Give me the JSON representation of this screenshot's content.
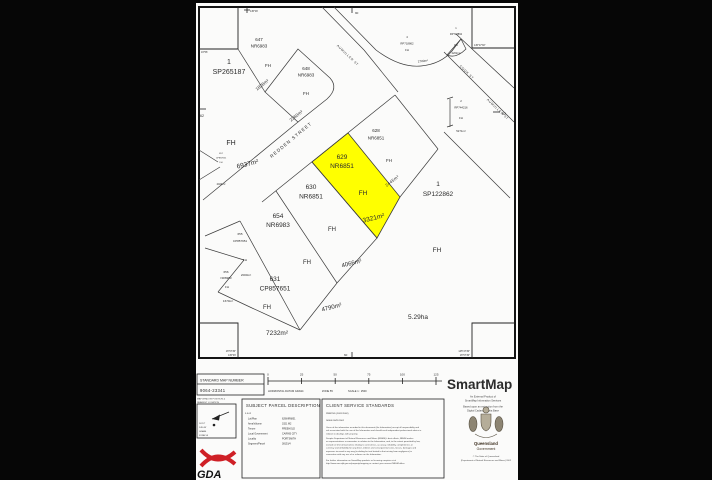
{
  "map": {
    "fh_label": "FH",
    "parcels": {
      "p647": {
        "lot": "647",
        "plan": "NR6983"
      },
      "p648": {
        "lot": "648",
        "plan": "NR6983"
      },
      "sp265187": {
        "lot": "1",
        "plan": "SP265187"
      },
      "rp718862a": {
        "lot": "4",
        "plan": "RP718862"
      },
      "rp718862b": {
        "lot": "1",
        "plan": "RP718862"
      },
      "rp744216": {
        "lot": "2",
        "plan": "RP744216"
      },
      "p628": {
        "lot": "628",
        "plan": "NR6851"
      },
      "p629": {
        "lot": "629",
        "plan": "NR6851"
      },
      "p630": {
        "lot": "630",
        "plan": "NR6851"
      },
      "sp122862": {
        "lot": "1",
        "plan": "SP122862"
      },
      "p654": {
        "lot": "654",
        "plan": "NR6983"
      },
      "p655": {
        "lot": "655",
        "plan": "CP857651"
      },
      "p656": {
        "lot": "656",
        "plan": "NR6983"
      },
      "p631": {
        "lot": "631",
        "plan": "CP857651"
      },
      "p657": {
        "lot": "657",
        "plan": "CP857651"
      }
    },
    "areas": {
      "a647": "1828m²",
      "a648": "2360m²",
      "a6937": "6937m²",
      "a2700": "2700m²",
      "a2202": "2202m²",
      "a5271": "5271m²",
      "a2445": "2445m²",
      "a3321": "3321m²",
      "a4066": "4066m²",
      "a4790": "4790m²",
      "a7232": "7232m²",
      "a529": "5.29ha",
      "a2000": "2000m²",
      "a1670": "1670m²",
      "a2024": "2024m²"
    },
    "streets": {
      "redden": "REDDEN STREET",
      "aumuller": "AUMULLER ST",
      "cook": "COOK ST",
      "aumuller2": "AUMULLER ST"
    },
    "edges": {
      "left": "62",
      "right": "62",
      "top": "90",
      "bottom": "60"
    },
    "corners": {
      "tl": "145°46'",
      "tr": "145°47'30\"",
      "lm": "16°56'",
      "bl1": "16°57'30\"",
      "bl2": "145°46'",
      "br1": "145°47'30\"",
      "br2": "16°57'30\""
    },
    "highlight_color": "#ffff00"
  },
  "footer": {
    "map_number_box": {
      "title": "STANDARD MAP NUMBER",
      "number": "9064-23341"
    },
    "window_note": [
      "MAP WINDOW POSITION &",
      "NEAREST LOCATION"
    ],
    "scalebar": {
      "ticks": [
        "0",
        "25",
        "50",
        "75",
        "100",
        "125"
      ],
      "datum": "HORIZONTAL DATUM GDA94",
      "zone": "ZONE 55",
      "scale": "SCALE 1 : 2500"
    },
    "north_box": [
      "16°57'",
      "145°46'",
      "GDA94",
      "ZONE 55"
    ],
    "brand": {
      "name": "SmartMap",
      "color": "#2a2ac8",
      "tagline1": "An External Product of",
      "tagline2": "SmartMap Information Services",
      "tagline3": "Based upon an extraction from the",
      "tagline4": "Digital Cadastral Data Base"
    },
    "gda": {
      "label": "GDA"
    },
    "subject": {
      "title": "SUBJECT PARCEL DESCRIPTION",
      "code": "5.5.02",
      "fields": [
        {
          "label": "Lot/Plan",
          "value": "629/NR6851"
        },
        {
          "label": "Area/Volume",
          "value": "3321 M2"
        },
        {
          "label": "Tenure",
          "value": "FREEHOLD"
        },
        {
          "label": "Local Government",
          "value": "CAIRNS CITY"
        },
        {
          "label": "Locality",
          "value": "PORTSMITH"
        },
        {
          "label": "Segment/Parcel",
          "value": "38151/4"
        }
      ]
    },
    "client": {
      "title": "CLIENT SERVICE STANDARDS",
      "printed": "PRINTED (20/11/2002)",
      "issue": "ISSUE    30/11/2002",
      "para": [
        "Users of the information recorded in this document (the Information) accept all responsibility and",
        "risk associated with the use of the Information and should seek independent professional advice in",
        "relation to dealings with property.",
        "Despite Department of Natural Resources and Mines (NR&M)'s best efforts, NR&M makes",
        "no representations or warranties in relation to the Information, and, to the extent permitted by law,",
        "exclude or limit all warranties relating to correctness, accuracy, reliability, completeness or",
        "currency and all liability for any direct, indirect and consequential costs, losses, damages and",
        "expenses incurred in any way (including but not limited to that arising from negligence) in",
        "connection with any use of or reliance on the Information.",
        "For further information on SmartMap products or licensing enquiries visit",
        "http://www.nrm.qld.gov.au/property/mapping or contact your nearest NR&M office."
      ]
    },
    "crest": {
      "line1": "Queensland",
      "line2": "Government",
      "copy1": "© The State of Queensland",
      "copy2": "(Department of Natural Resources and Mines) 2002"
    }
  }
}
